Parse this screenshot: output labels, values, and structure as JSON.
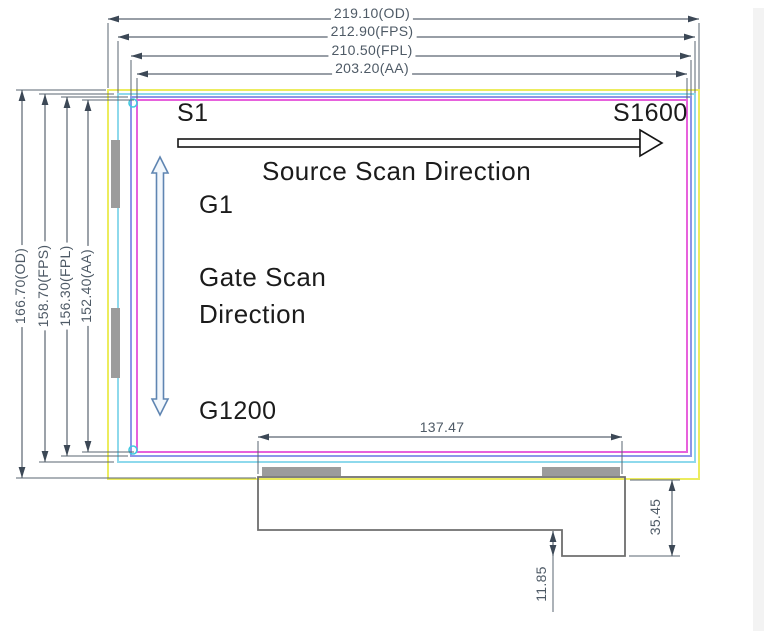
{
  "drawing": {
    "title": "LCD panel outline drawing",
    "dim_labels": {
      "width_od": "219.10(OD)",
      "width_fps": "212.90(FPS)",
      "width_fpl": "210.50(FPL)",
      "width_aa": "203.20(AA)",
      "height_od": "166.70(OD)",
      "height_fps": "158.70(FPS)",
      "height_fpl": "156.30(FPL)",
      "height_aa": "152.40(AA)",
      "tab_width": "137.47",
      "tab_height": "35.45",
      "tab_step": "11.85"
    },
    "labels": {
      "source_start": "S1",
      "source_end": "S1600",
      "source_direction": "Source Scan Direction",
      "gate_start": "G1",
      "gate_direction_line1": "Gate Scan",
      "gate_direction_line2": "Direction",
      "gate_end": "G1200"
    },
    "colors": {
      "od_outline": "#ecec5e",
      "fps_outline": "#8ed9ec",
      "fpl_outline": "#8d96e8",
      "aa_outline": "#e761dc",
      "corner_mark": "#3fc9e0",
      "pad_gray": "#9c9c9c",
      "tab_line": "#6e6e6e",
      "dim_line": "#5a6570",
      "ext_line": "#8a939c",
      "arrowhead": "#3c4856",
      "gate_arrow_stroke": "#5f85b2",
      "gate_arrow_fill": "#f2f7fc",
      "source_arrow_stroke": "#151515"
    }
  }
}
